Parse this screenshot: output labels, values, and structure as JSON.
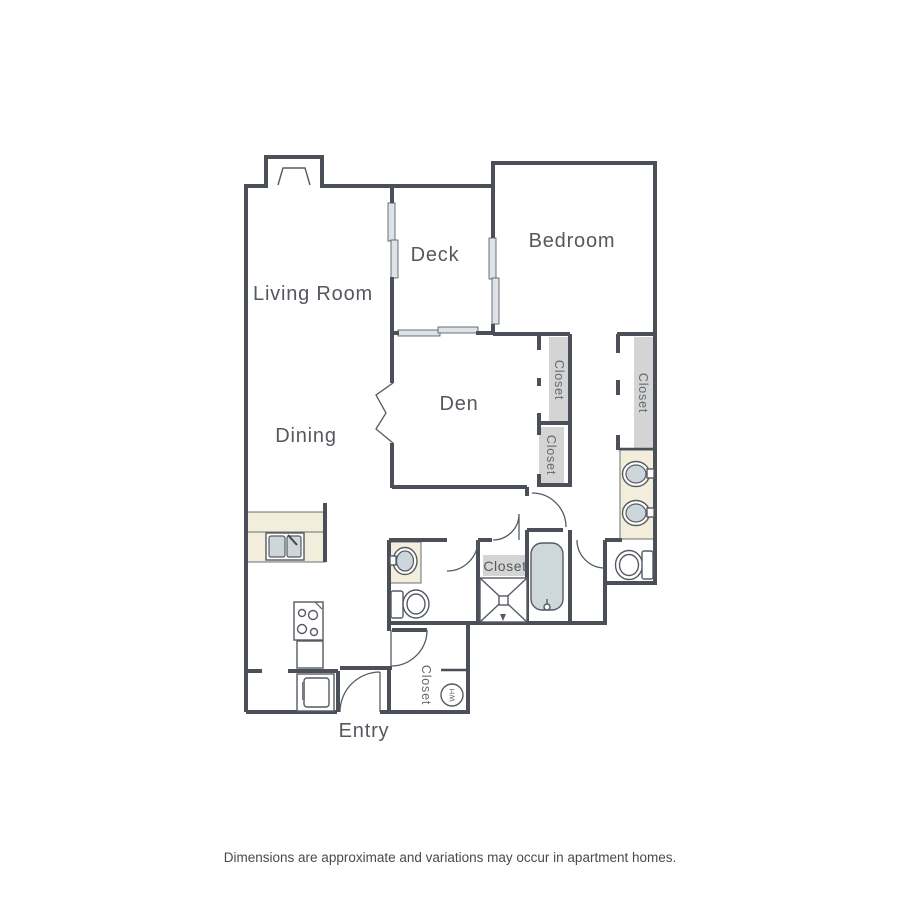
{
  "floor_plan": {
    "rooms": {
      "living_room": "Living Room",
      "dining": "Dining",
      "deck": "Deck",
      "bedroom": "Bedroom",
      "den": "Den",
      "entry": "Entry"
    },
    "closets": {
      "den_closet_upper": "Closet",
      "den_closet_lower": "Closet",
      "bedroom_closet": "Closet",
      "hall_closet": "Closet",
      "entry_closet": "Closet"
    },
    "appliances": {
      "water_heater_abbr": "WH"
    },
    "colors": {
      "wall": "#4b4f58",
      "counter_fill": "#f2eedb",
      "fixture_fill": "#cdd7dc",
      "closet_shelf_fill": "#d4d4d4",
      "window_fill": "#dde3e6",
      "label_text": "#55585e"
    }
  },
  "footer": {
    "disclaimer": "Dimensions are approximate and variations may occur in apartment homes."
  }
}
